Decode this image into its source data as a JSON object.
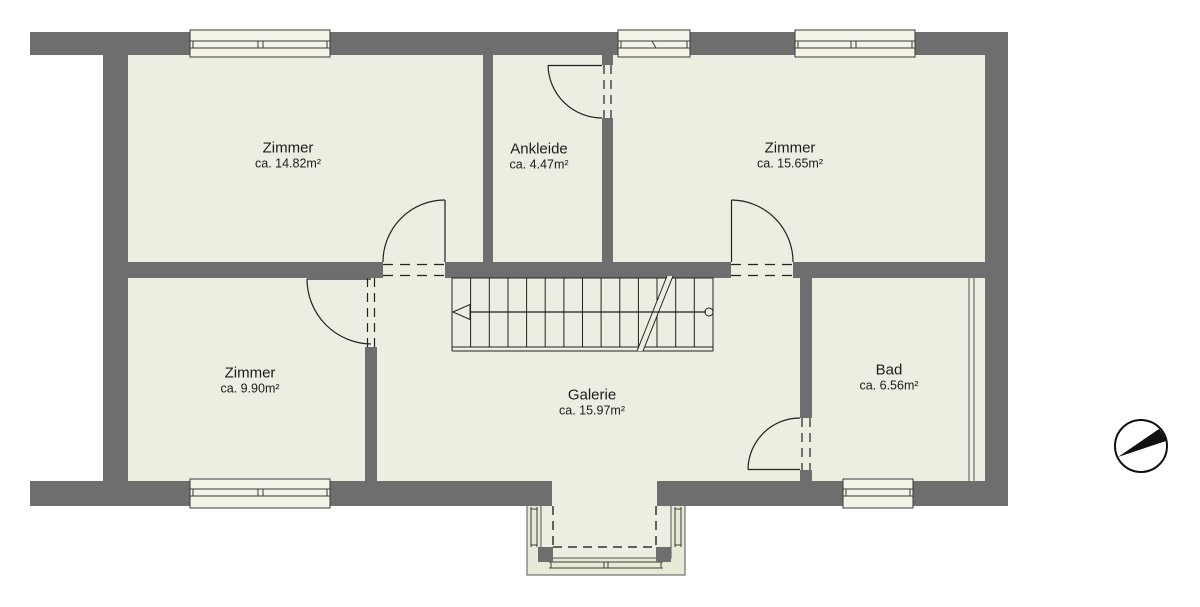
{
  "document": {
    "kind": "floor-plan-drawing",
    "language": "de"
  },
  "rooms": [
    {
      "id": "zimmer-top-left",
      "name": "Zimmer",
      "area": "ca. 14.82m²"
    },
    {
      "id": "ankleide",
      "name": "Ankleide",
      "area": "ca. 4.47m²"
    },
    {
      "id": "zimmer-top-right",
      "name": "Zimmer",
      "area": "ca. 15.65m²"
    },
    {
      "id": "zimmer-bottom-left",
      "name": "Zimmer",
      "area": "ca. 9.90m²"
    },
    {
      "id": "galerie",
      "name": "Galerie",
      "area": "ca. 15.97m²"
    },
    {
      "id": "bad",
      "name": "Bad",
      "area": "ca. 6.56m²"
    }
  ],
  "icons": [
    {
      "name": "north-arrow-icon",
      "description": "compass circle with black wedge pointing north-east"
    }
  ],
  "colors": {
    "wall_fill": "#6e6e6e",
    "floor_fill": "#ebeee0",
    "window_fill": "#f3f4e7",
    "bay_wall_fill": "#e9e9d8",
    "line": "#222222",
    "background": "#ffffff"
  },
  "features": {
    "stair": {
      "treads": 14,
      "walk_line": "arrow pointing left with circle start at right",
      "break_line": "double diagonal"
    },
    "doors": 5,
    "windows": 5,
    "bay": "open loggia at bottom center with two posts"
  }
}
